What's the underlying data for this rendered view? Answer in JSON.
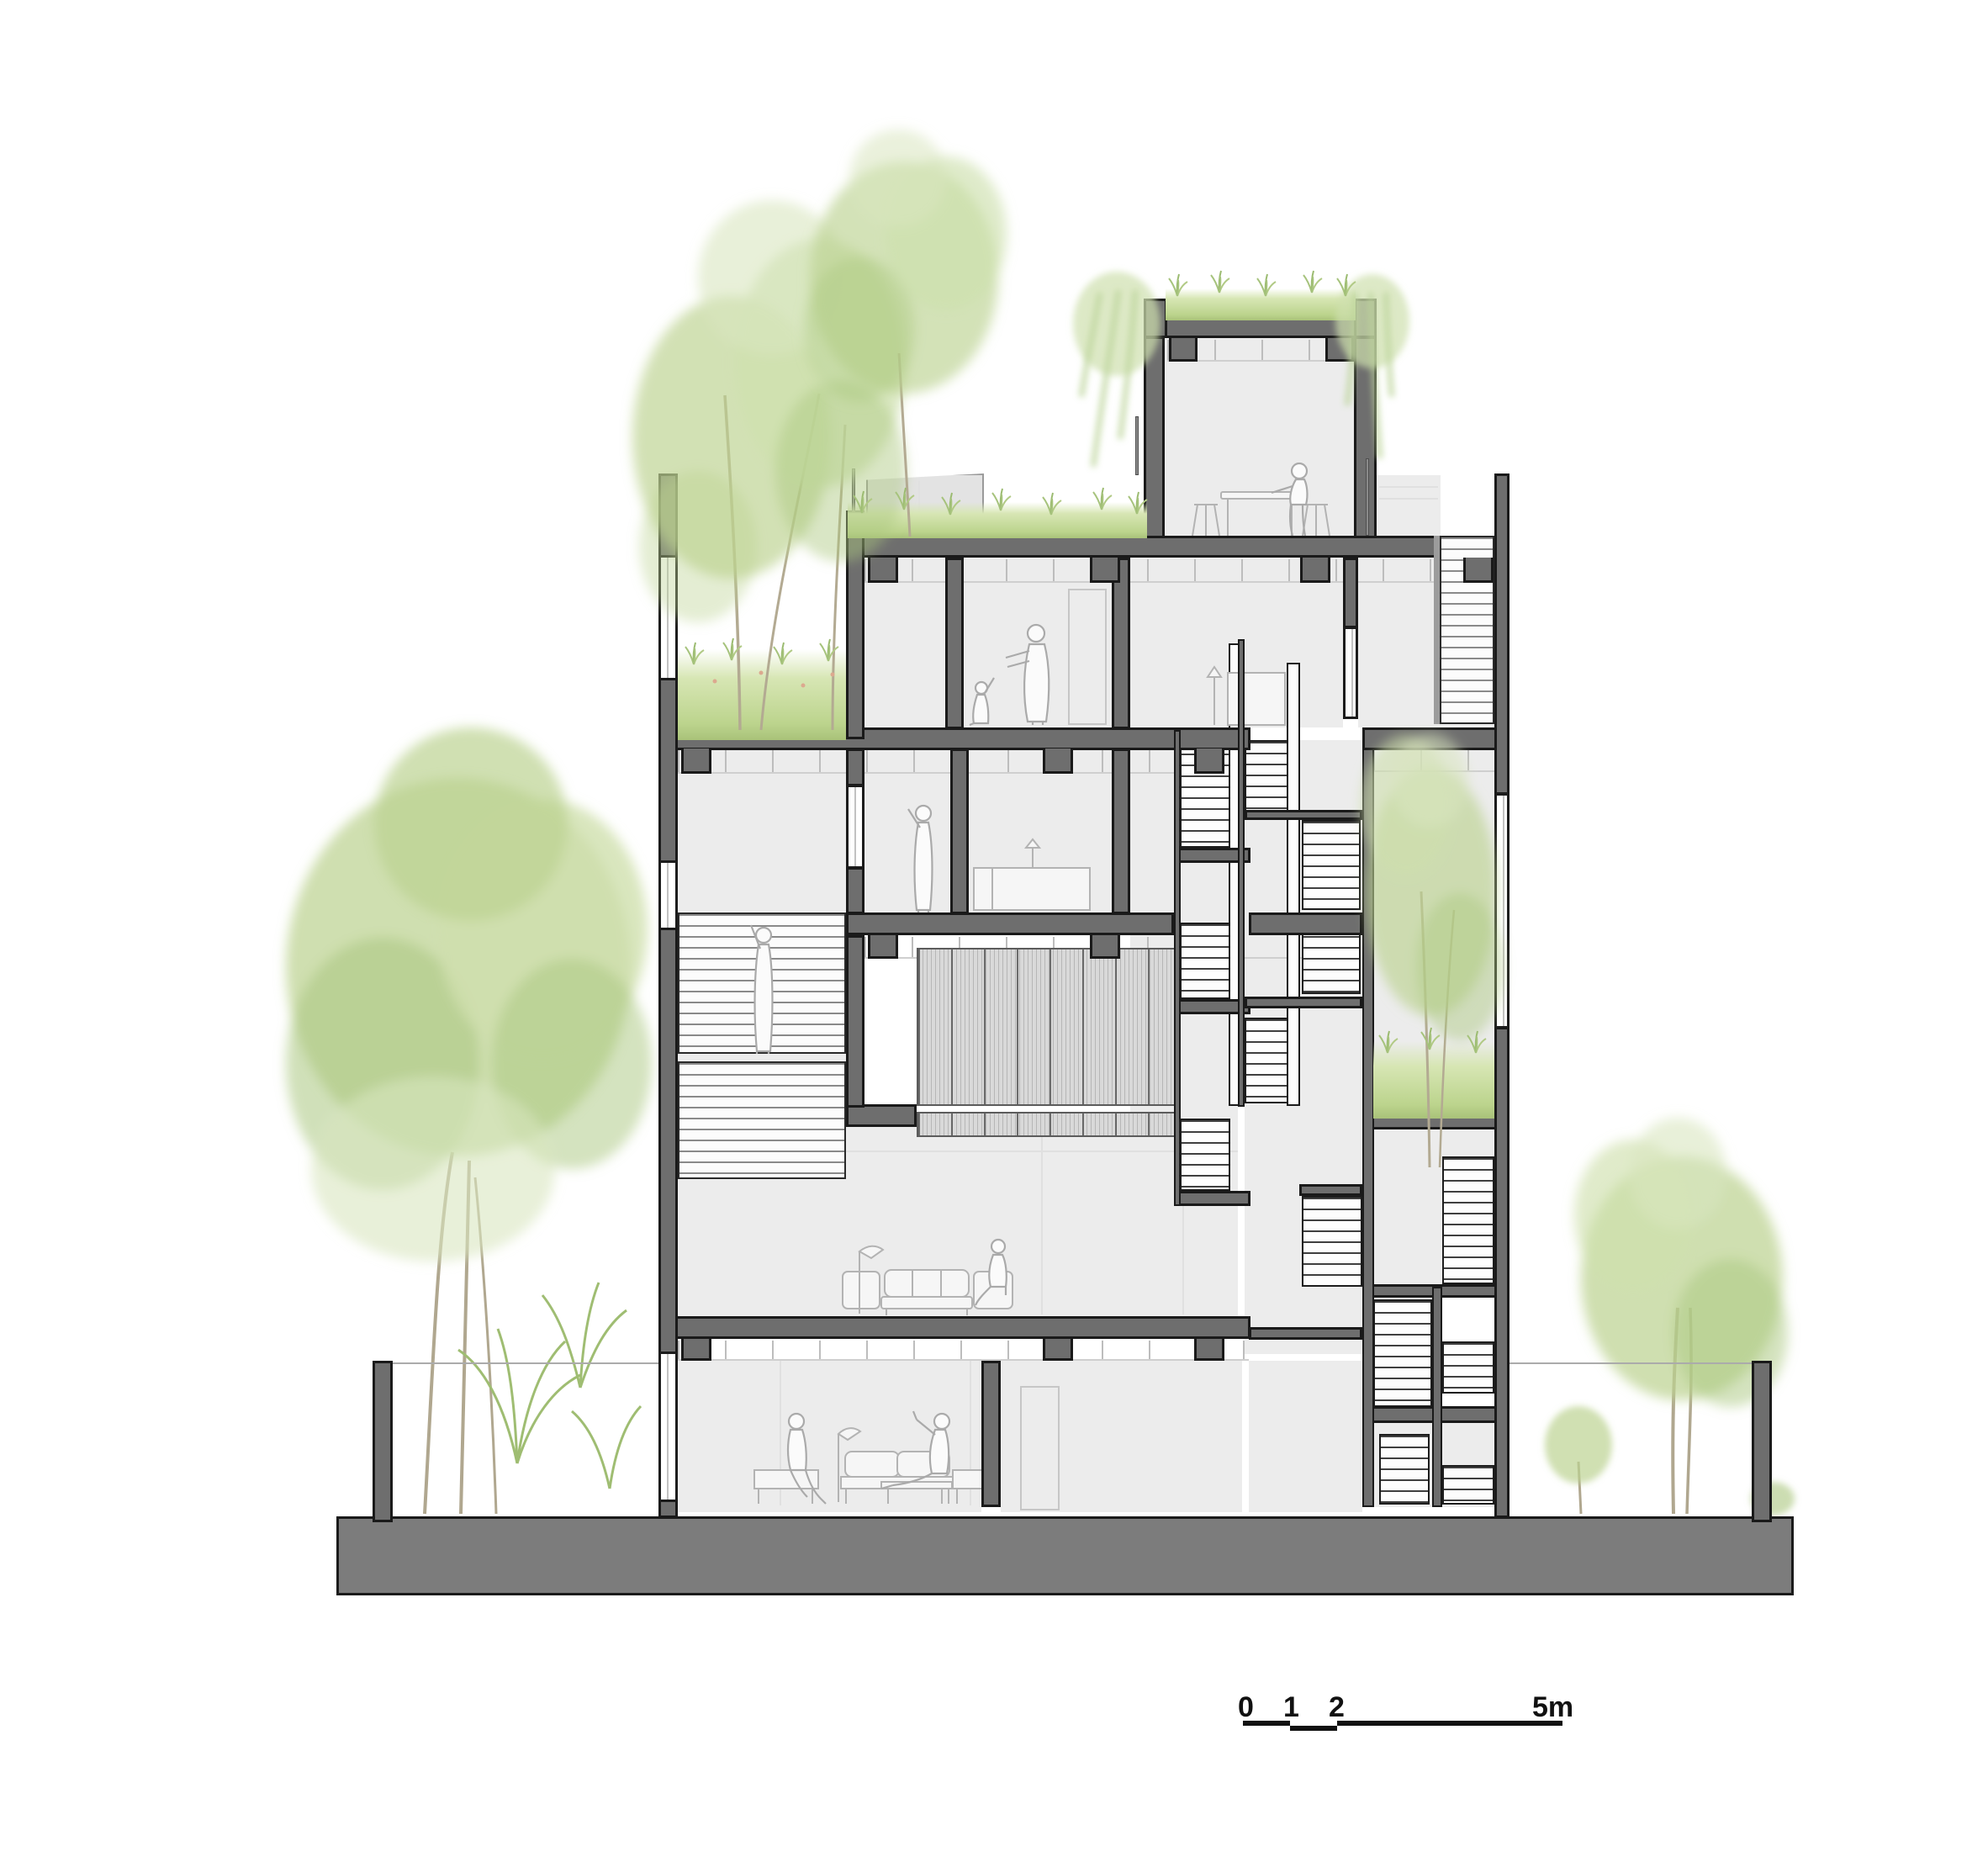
{
  "title": "Building cross-section drawing",
  "scale_bar": {
    "labels": {
      "zero": "0",
      "one": "1",
      "two": "2",
      "five": "5m"
    }
  },
  "palette": {
    "section_cut_gray": "#6e6e6e",
    "outline_black": "#1a1a1a",
    "room_fill": "#ececec",
    "ground_mass": "#7c7c7c",
    "grass_green": "#bcd48d",
    "foliage_green": "#b9d193",
    "figure_line_gray": "#aaaaaa"
  },
  "annotations": {
    "vegetation": [
      "street-tree-left",
      "palm-shrubs-left",
      "planter-trees-upper-left",
      "rooftop-tree",
      "green-roof-penthouse",
      "hanging-vines",
      "courtyard-tree-right",
      "street-tree-right",
      "sapling-right",
      "meadow-planter-left",
      "grass-planter-right",
      "roof-grass"
    ],
    "figures": [
      "person-at-rooftop-table",
      "adult-with-child",
      "person-waving",
      "person-on-stair-louver",
      "person-seated-living",
      "person-lounge-left",
      "person-lounge-right"
    ],
    "furniture": [
      "high-table-and-stools",
      "sideboard-and-lamp",
      "bed-platform",
      "sofa-set-living",
      "floor-lamp-living",
      "lounge-benches",
      "lounge-floor-lamp",
      "low-table"
    ],
    "structure": [
      "ground-slab",
      "garden-wall-posts",
      "left-facade-wall",
      "right-facade-wall",
      "floor-slabs",
      "stair-flights",
      "louver-screen",
      "white-columns",
      "roof-terrace-box",
      "window-gaps",
      "door-frames"
    ]
  }
}
